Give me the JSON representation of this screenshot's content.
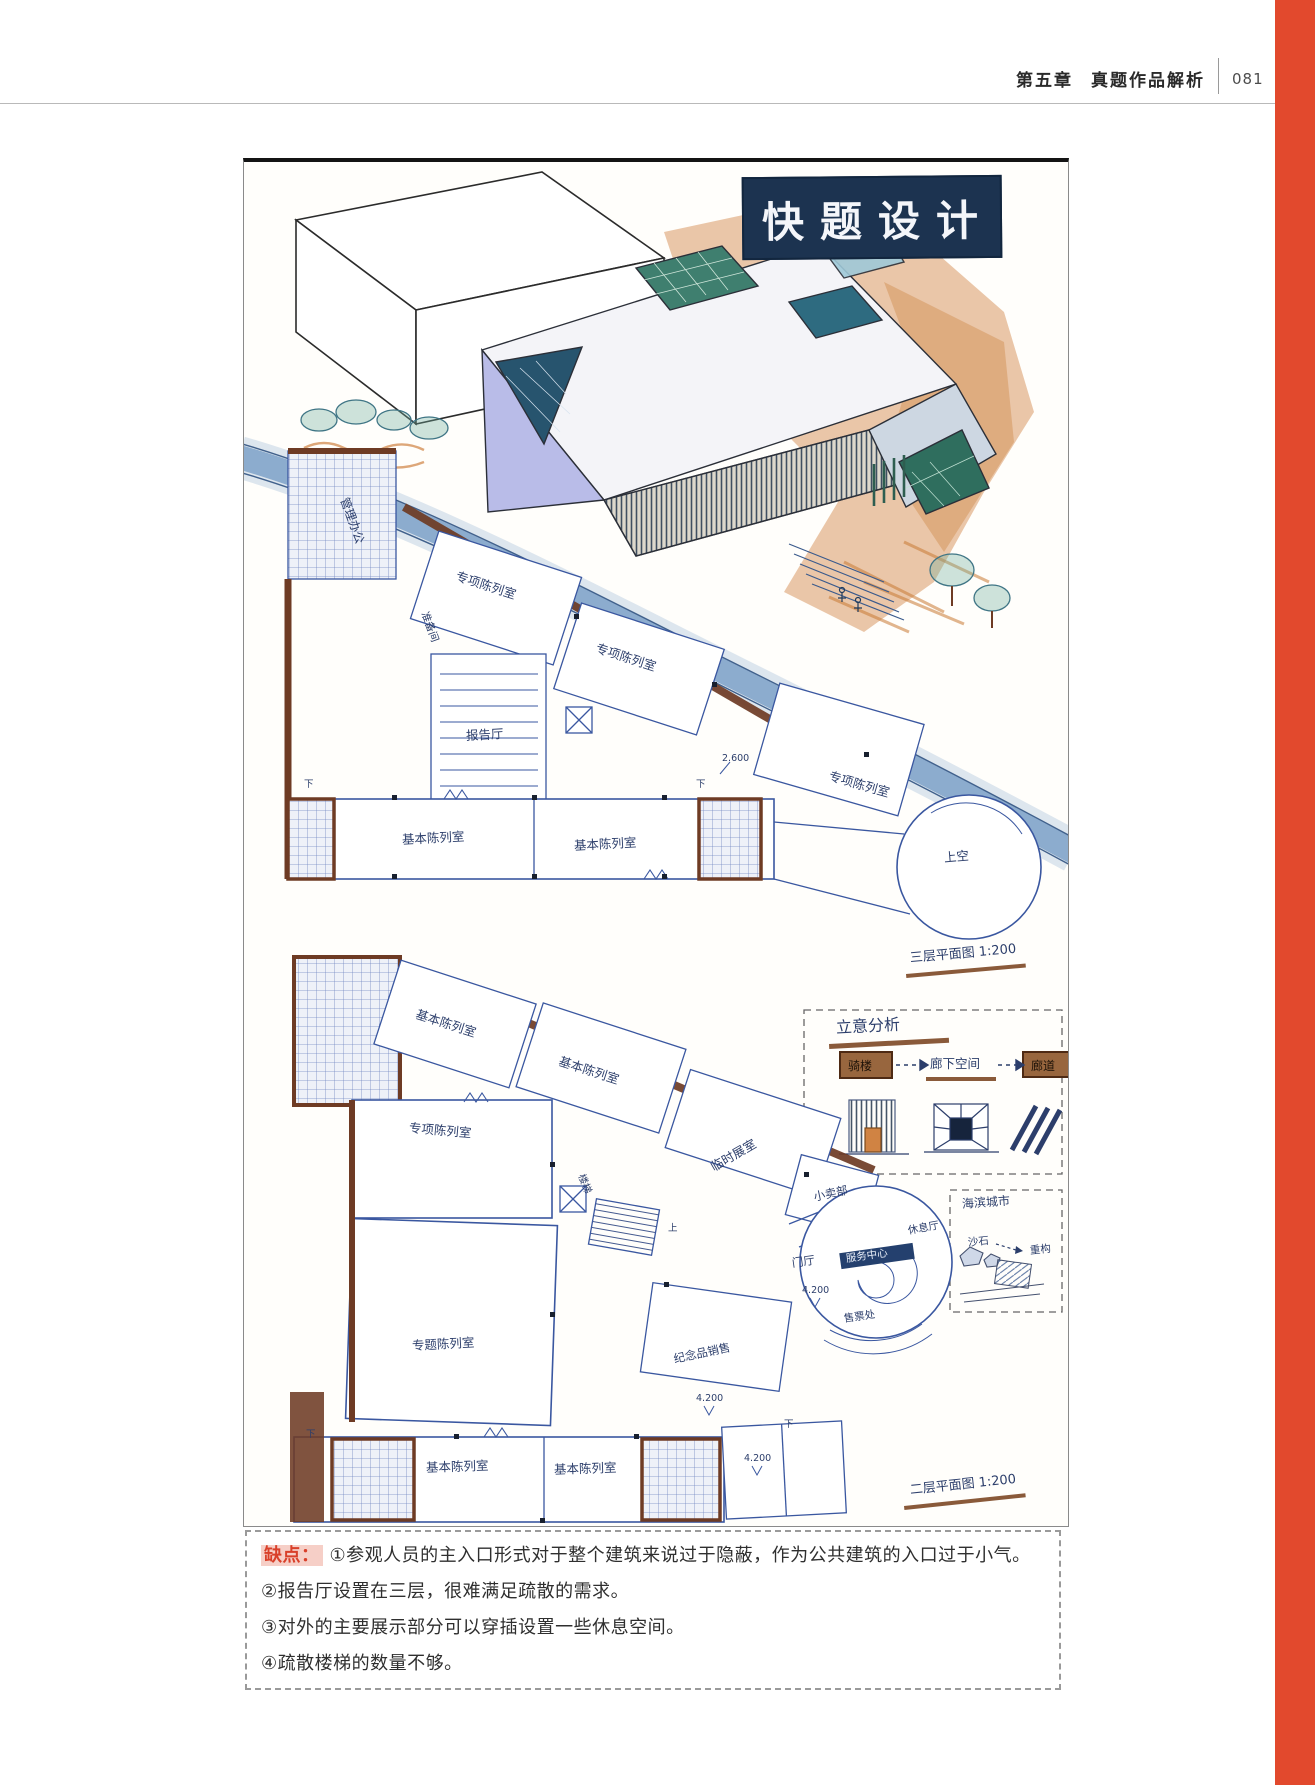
{
  "page": {
    "accent_bar_color": "#e2492d"
  },
  "header": {
    "chapter": "第五章",
    "section": "真题作品解析",
    "page_number": "081"
  },
  "artwork": {
    "logo_text": "快题设计",
    "colors": {
      "ink_blue": "#2c3e6b",
      "wall_brown": "#6e3b24",
      "marker_orange": "#cf8040",
      "water_blue": "#6a93c0",
      "glass_teal": "#2e6b80",
      "glass_green": "#3f7f6f"
    },
    "labels": [
      {
        "t": "管理办公",
        "x": 100,
        "y": 330,
        "r": 70,
        "s": 12,
        "n": "room-label"
      },
      {
        "t": "准备间",
        "x": 180,
        "y": 445,
        "r": 70,
        "s": 10.5,
        "n": "room-label"
      },
      {
        "t": "专项陈列室",
        "x": 212,
        "y": 408,
        "r": 18,
        "s": 12.5,
        "n": "room-label"
      },
      {
        "t": "专项陈列室",
        "x": 352,
        "y": 480,
        "r": 18,
        "s": 12.5,
        "n": "room-label"
      },
      {
        "t": "专项陈列室",
        "x": 585,
        "y": 608,
        "r": 16,
        "s": 12.5,
        "n": "room-label"
      },
      {
        "t": "报告厅",
        "x": 222,
        "y": 568,
        "r": -3,
        "s": 12.5,
        "n": "room-label"
      },
      {
        "t": "基本陈列室",
        "x": 158,
        "y": 672,
        "r": -3,
        "s": 12.5,
        "n": "room-label"
      },
      {
        "t": "基本陈列室",
        "x": 330,
        "y": 678,
        "r": -3,
        "s": 12.5,
        "n": "room-label"
      },
      {
        "t": "上空",
        "x": 700,
        "y": 690,
        "r": -5,
        "s": 12.5,
        "n": "void-label"
      },
      {
        "t": "2.600",
        "x": 478,
        "y": 592,
        "r": 0,
        "s": 9.5,
        "n": "elevation-label"
      },
      {
        "t": "下",
        "x": 452,
        "y": 618,
        "r": 0,
        "s": 9.5,
        "n": "stair-direction-label"
      },
      {
        "t": "下",
        "x": 60,
        "y": 618,
        "r": 0,
        "s": 9.5,
        "n": "stair-direction-label"
      },
      {
        "t": "三层平面图 1:200",
        "x": 666,
        "y": 790,
        "r": -5,
        "s": 13,
        "n": "plan-title-3f"
      },
      {
        "t": "立意分析",
        "x": 592,
        "y": 858,
        "r": -3,
        "s": 16,
        "n": "concept-title"
      },
      {
        "t": "骑楼",
        "x": 604,
        "y": 898,
        "r": 0,
        "s": 12,
        "c": "#1d1208",
        "n": "concept-step"
      },
      {
        "t": "廊下空间",
        "x": 686,
        "y": 896,
        "r": 0,
        "s": 12.5,
        "n": "concept-step"
      },
      {
        "t": "廊道",
        "x": 787,
        "y": 898,
        "r": 0,
        "s": 12,
        "c": "#1d1208",
        "n": "concept-step"
      },
      {
        "t": "海滨城市",
        "x": 718,
        "y": 1036,
        "r": -4,
        "s": 12,
        "n": "site-note"
      },
      {
        "t": "沙石",
        "x": 724,
        "y": 1076,
        "r": -6,
        "s": 10.5,
        "n": "site-note"
      },
      {
        "t": "重构",
        "x": 786,
        "y": 1084,
        "r": -6,
        "s": 10.5,
        "n": "site-note"
      },
      {
        "t": "基本陈列室",
        "x": 172,
        "y": 846,
        "r": 18,
        "s": 12.5,
        "n": "room-label"
      },
      {
        "t": "基本陈列室",
        "x": 315,
        "y": 893,
        "r": 18,
        "s": 12.5,
        "n": "room-label"
      },
      {
        "t": "专项陈列室",
        "x": 165,
        "y": 960,
        "r": 5,
        "s": 12.5,
        "n": "room-label"
      },
      {
        "t": "专题陈列室",
        "x": 168,
        "y": 1178,
        "r": -3,
        "s": 12.5,
        "n": "room-label"
      },
      {
        "t": "临时展室",
        "x": 468,
        "y": 1000,
        "r": -30,
        "s": 12.5,
        "n": "room-label"
      },
      {
        "t": "小卖部",
        "x": 570,
        "y": 1030,
        "r": -12,
        "s": 11.5,
        "n": "room-label"
      },
      {
        "t": "楼梯",
        "x": 336,
        "y": 1008,
        "r": 68,
        "s": 10,
        "n": "room-label"
      },
      {
        "t": "上",
        "x": 424,
        "y": 1062,
        "r": 0,
        "s": 9.5,
        "n": "stair-direction-label"
      },
      {
        "t": "纪念品销售",
        "x": 430,
        "y": 1192,
        "r": -12,
        "s": 11.5,
        "n": "room-label"
      },
      {
        "t": "门厅",
        "x": 548,
        "y": 1096,
        "r": -8,
        "s": 11.5,
        "n": "room-label"
      },
      {
        "t": "服务中心",
        "x": 602,
        "y": 1092,
        "r": -8,
        "s": 10.5,
        "c": "#e8eef8",
        "n": "room-label"
      },
      {
        "t": "休息厅",
        "x": 664,
        "y": 1064,
        "r": -10,
        "s": 10.5,
        "n": "room-label"
      },
      {
        "t": "售票处",
        "x": 600,
        "y": 1152,
        "r": -8,
        "s": 10.5,
        "n": "room-label"
      },
      {
        "t": "4.200",
        "x": 558,
        "y": 1124,
        "r": 0,
        "s": 9.5,
        "n": "elevation-label"
      },
      {
        "t": "4.200",
        "x": 452,
        "y": 1232,
        "r": 0,
        "s": 9.5,
        "n": "elevation-label"
      },
      {
        "t": "4.200",
        "x": 500,
        "y": 1292,
        "r": 0,
        "s": 9.5,
        "n": "elevation-label"
      },
      {
        "t": "基本陈列室",
        "x": 182,
        "y": 1300,
        "r": -2,
        "s": 12.5,
        "n": "room-label"
      },
      {
        "t": "基本陈列室",
        "x": 310,
        "y": 1302,
        "r": -2,
        "s": 12.5,
        "n": "room-label"
      },
      {
        "t": "下",
        "x": 62,
        "y": 1268,
        "r": 0,
        "s": 9.5,
        "n": "stair-direction-label"
      },
      {
        "t": "下",
        "x": 540,
        "y": 1258,
        "r": 0,
        "s": 9.5,
        "n": "stair-direction-label"
      },
      {
        "t": "二层平面图 1:200",
        "x": 666,
        "y": 1322,
        "r": -6,
        "s": 13,
        "n": "plan-title-2f"
      }
    ]
  },
  "critique": {
    "tag": "缺点：",
    "points": [
      "①参观人员的主入口形式对于整个建筑来说过于隐蔽，作为公共建筑的入口过于小气。",
      "②报告厅设置在三层，很难满足疏散的需求。",
      "③对外的主要展示部分可以穿插设置一些休息空间。",
      "④疏散楼梯的数量不够。"
    ]
  }
}
